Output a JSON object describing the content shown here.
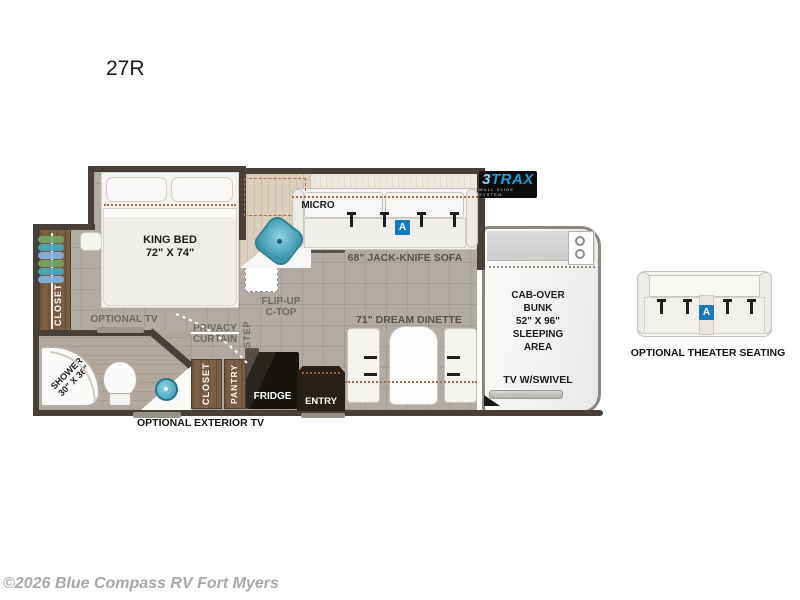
{
  "page": {
    "model": "27R",
    "copyright": "©2026 Blue Compass RV Fort Myers"
  },
  "brand_logo": {
    "number": "3",
    "word": "TRAX",
    "tagline": "WALL SLIDE SYSTEM"
  },
  "colors": {
    "accent_blue": "#1779bd",
    "wall": "#483f39",
    "cabinet_wood": "#7b5f45",
    "counter_wood": "#dbcfbe",
    "sink_teal": "#58b4c6",
    "floor": "#b2aba4"
  },
  "floorplan": {
    "bedroom": {
      "king_bed": "KING BED\n72\" X 74\"",
      "closet": "CLOSET",
      "optional_tv": "OPTIONAL TV",
      "privacy_curtain": "PRIVACY\nCURTAIN"
    },
    "bathroom": {
      "shower": "SHOWER\n30\" X 36\""
    },
    "kitchen": {
      "micro": "MICRO",
      "flip_up_ctop": "FLIP-UP\nC-TOP",
      "step": "STEP"
    },
    "hall": {
      "closet": "CLOSET",
      "pantry": "PANTRY",
      "fridge": "FRIDGE",
      "entry": "ENTRY"
    },
    "living": {
      "sofa": "68\" JACK-KNIFE SOFA",
      "dinette": "71\" DREAM DINETTE",
      "seat_badge": "A"
    },
    "cab": {
      "bunk": "CAB-OVER\nBUNK\n52\" X 96\"\nSLEEPING\nAREA",
      "tv": "TV W/SWIVEL"
    },
    "exterior": {
      "optional_exterior_tv": "OPTIONAL EXTERIOR TV"
    }
  },
  "options": {
    "theater_seating": {
      "label": "OPTIONAL THEATER SEATING",
      "seat_badge": "A"
    }
  }
}
